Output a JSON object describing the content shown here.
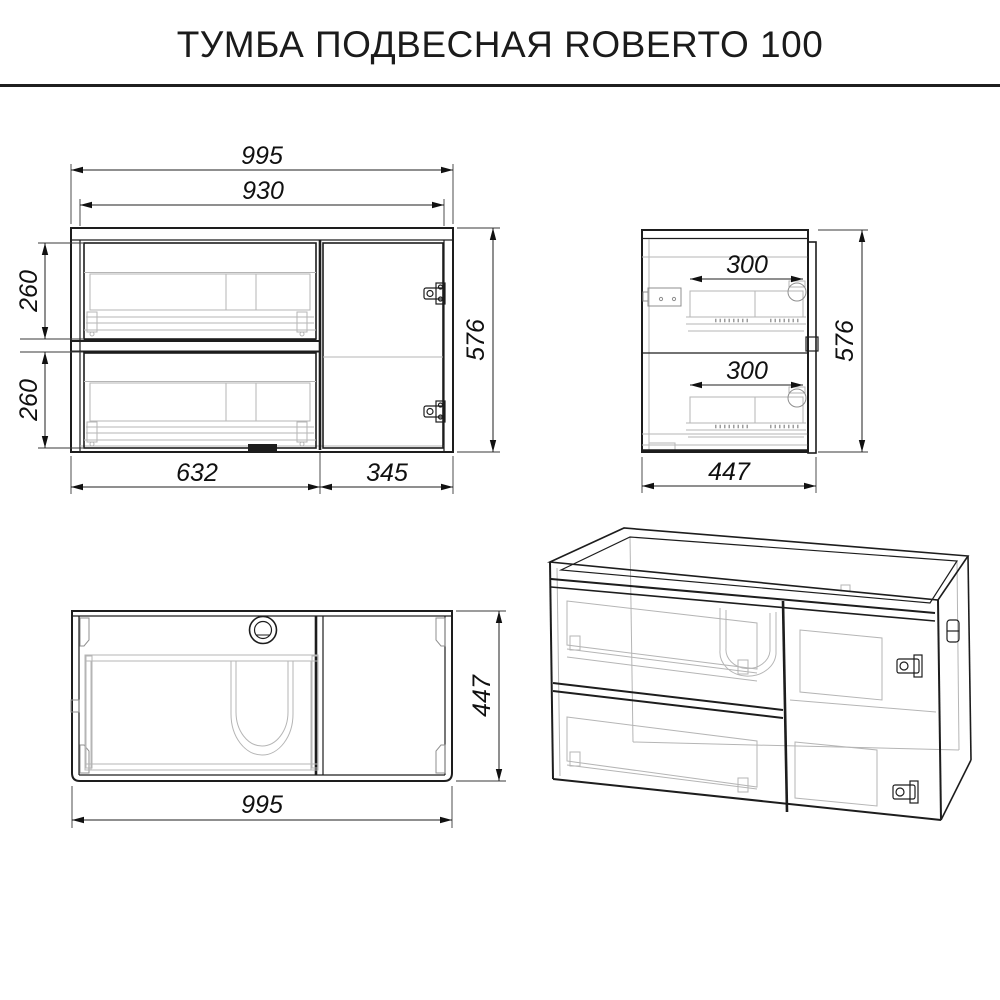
{
  "title": "ТУМБА ПОДВЕСНАЯ ROBERTO 100",
  "views": {
    "front": {
      "dims": {
        "total_width": "995",
        "inner_width": "930",
        "top_drawer_height": "260",
        "bottom_drawer_height": "260",
        "height": "576",
        "drawers_width": "632",
        "door_width": "345"
      }
    },
    "side": {
      "dims": {
        "top_drawer_depth": "300",
        "bottom_drawer_depth": "300",
        "height": "576",
        "depth": "447"
      }
    },
    "top": {
      "dims": {
        "width": "995",
        "depth": "447"
      }
    }
  },
  "colors": {
    "line": "#1d1d1d",
    "light_line": "#b5b5b5",
    "background": "#ffffff"
  }
}
